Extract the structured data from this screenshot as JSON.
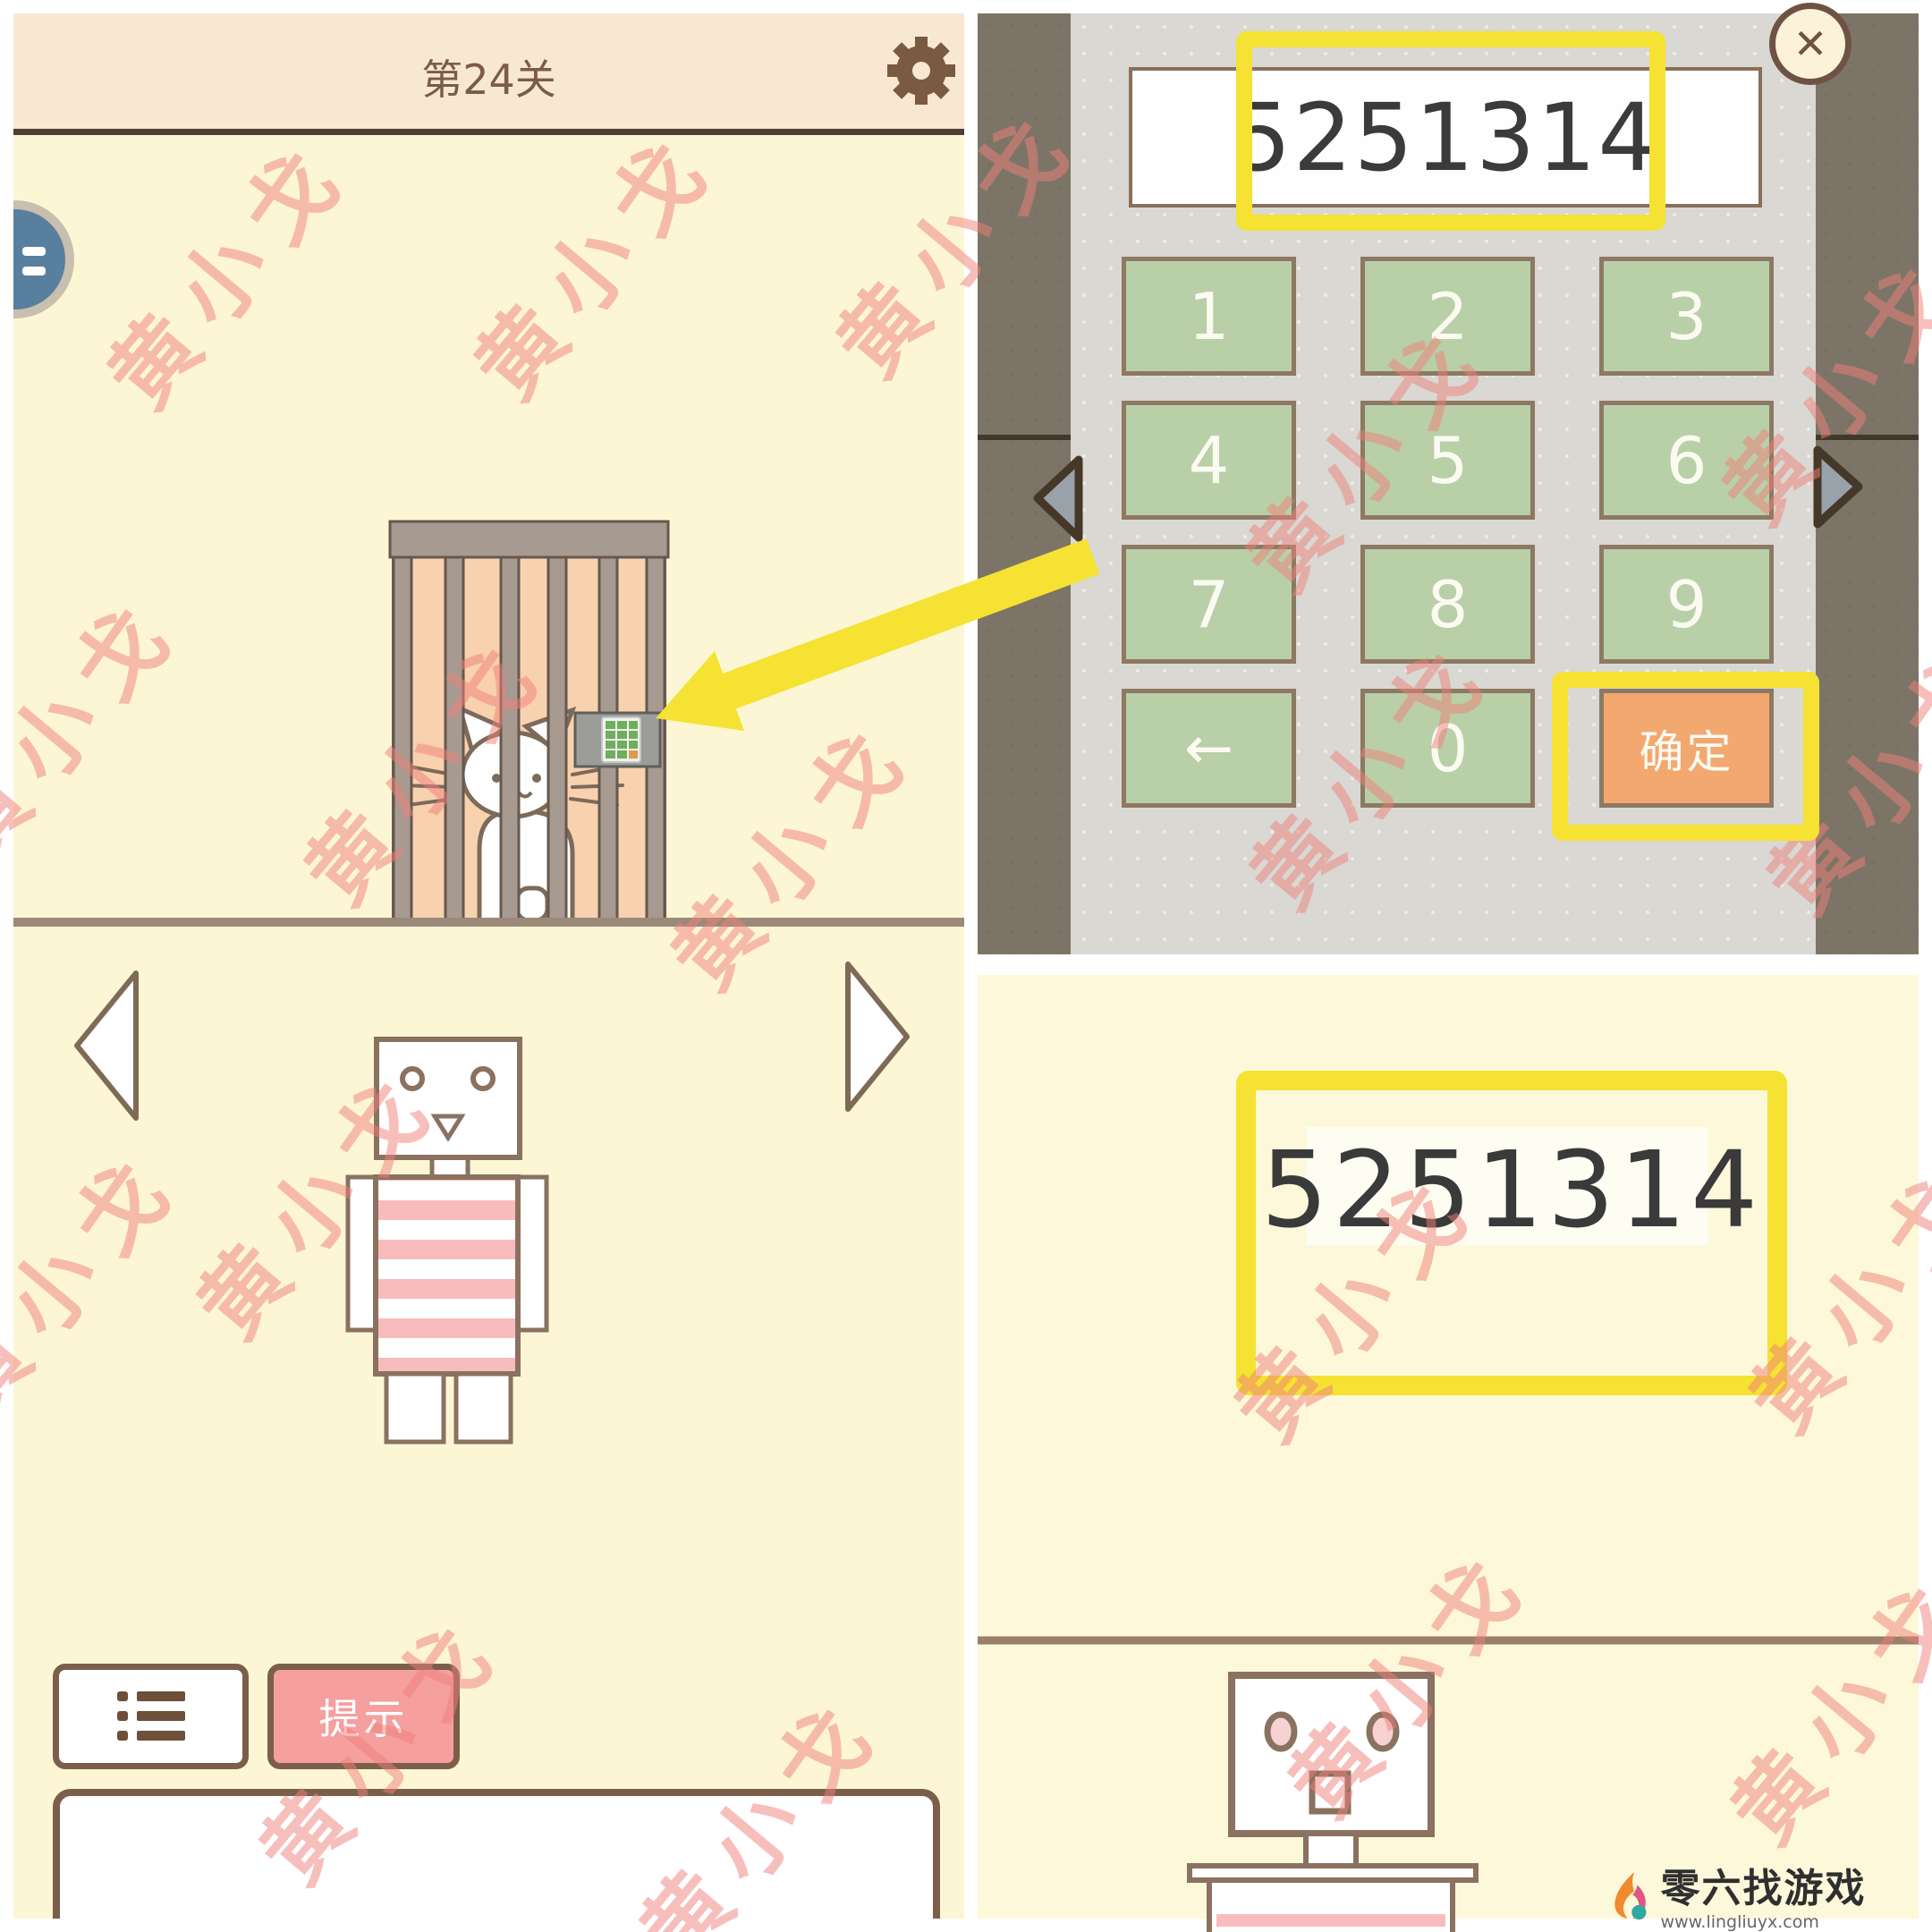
{
  "watermark": {
    "text": "黄小戈",
    "color": "#f0807a"
  },
  "left_panel": {
    "title": "第24关",
    "hint_label": "提示",
    "icons": [
      "gear-icon",
      "list-icon",
      "blue-badge",
      "prev-arrow-icon",
      "next-arrow-icon"
    ],
    "scene": {
      "objects": [
        "cat-in-cage",
        "keypad-safe",
        "robot-striped-shirt"
      ]
    }
  },
  "keypad_dialog": {
    "close_label": "✕",
    "input_value": "5251314",
    "keys": [
      {
        "label": "1",
        "type": "digit"
      },
      {
        "label": "2",
        "type": "digit"
      },
      {
        "label": "3",
        "type": "digit"
      },
      {
        "label": "4",
        "type": "digit"
      },
      {
        "label": "5",
        "type": "digit"
      },
      {
        "label": "6",
        "type": "digit"
      },
      {
        "label": "7",
        "type": "digit"
      },
      {
        "label": "8",
        "type": "digit"
      },
      {
        "label": "9",
        "type": "digit"
      },
      {
        "label": "←",
        "type": "backspace"
      },
      {
        "label": "0",
        "type": "digit"
      },
      {
        "label": "确定",
        "type": "confirm"
      }
    ]
  },
  "answer_panel": {
    "code": "5251314"
  },
  "logo": {
    "name": "零六找游戏",
    "urls": "www.lingliuyx.com   www.06zyx.com",
    "icon": "flame-icon"
  },
  "colors": {
    "annotation_yellow": "#f5e232",
    "key_green": "#b9cfa8",
    "confirm_orange": "#f3a870",
    "hint_pink": "#f59f9f",
    "olive_background": "#7c7567",
    "dialog_gray": "#d9d8d3",
    "cream_background": "#fcf6d5",
    "header_peach": "#f8e8d2",
    "outline_brown": "#7b5f4b",
    "cage_fill": "#f8d1ae",
    "stripe_pink": "#f9bcbc"
  }
}
